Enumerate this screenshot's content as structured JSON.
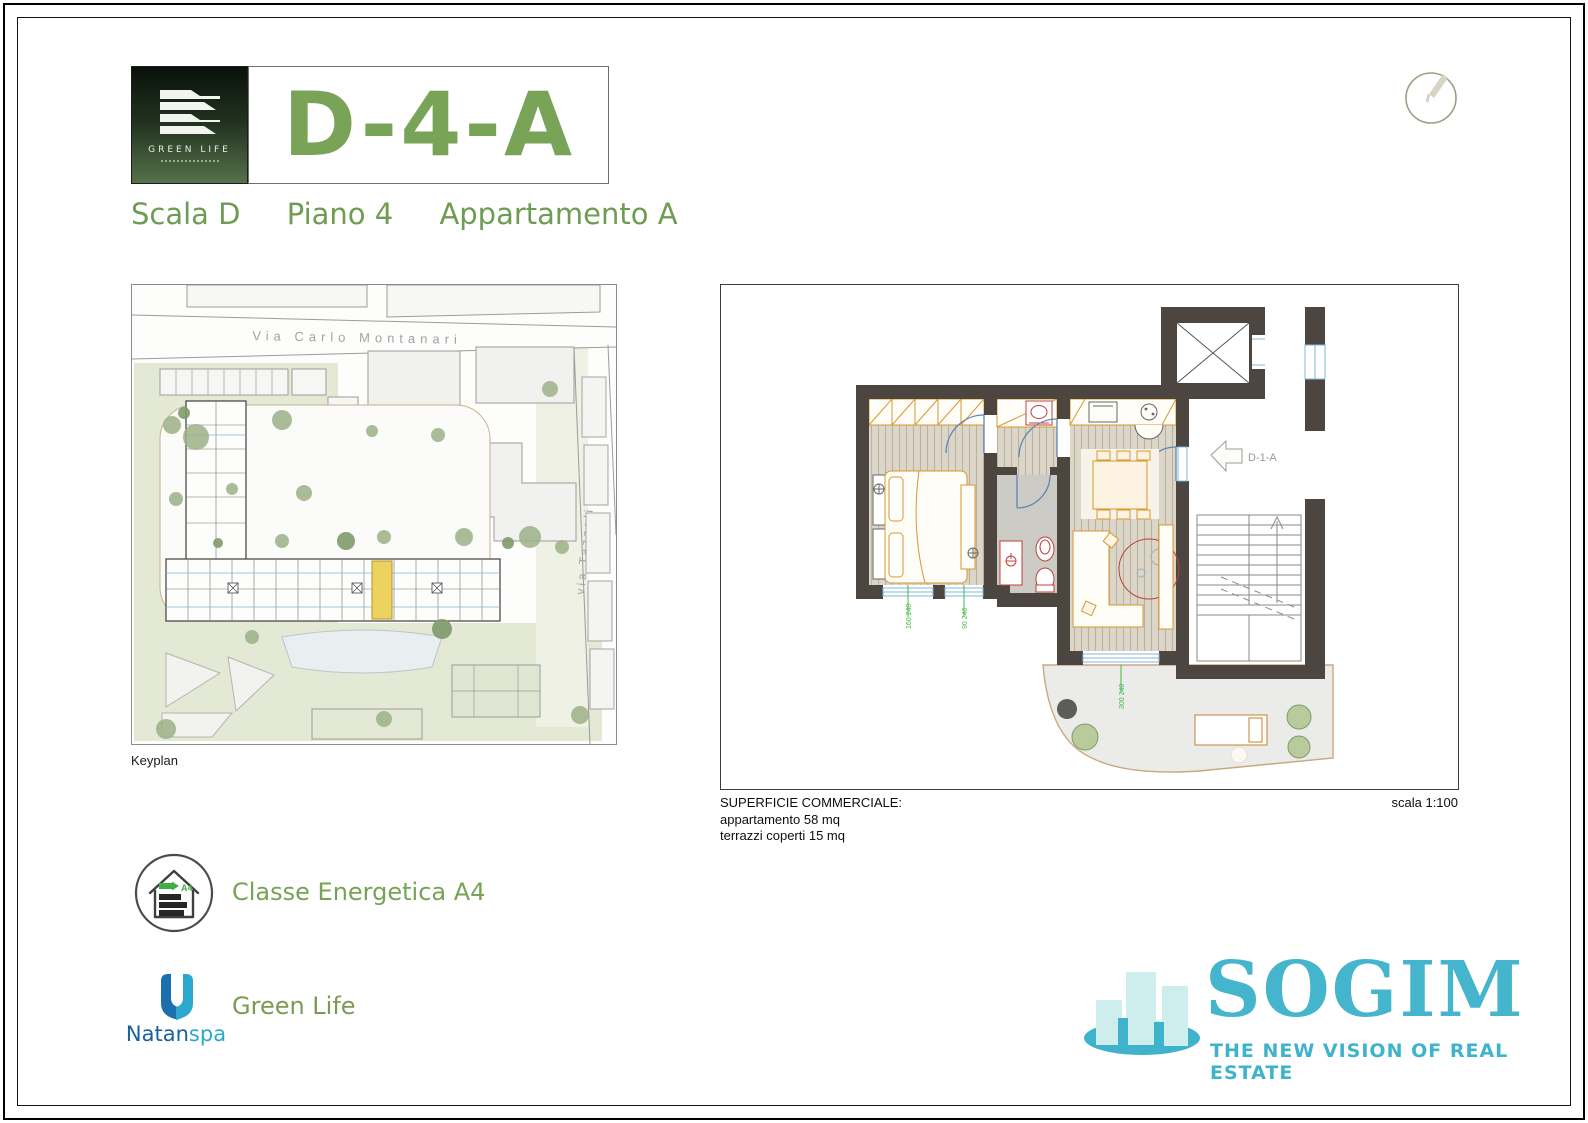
{
  "header": {
    "unit_code": "D-4-A",
    "scala": "Scala D",
    "piano": "Piano 4",
    "appartamento": "Appartamento A",
    "logo_title": "GREEN LIFE"
  },
  "keyplan": {
    "label": "Keyplan",
    "street_top": "Via Carlo Montanari",
    "street_right": "via Tazzoli"
  },
  "plan": {
    "entry_label": "D-1-A",
    "scale_label": "scala 1:100",
    "surface_title": "SUPERFICIE  COMMERCIALE:",
    "surface_line1": "appartamento 58 mq",
    "surface_line2": "terrazzi coperti 15 mq",
    "dims": [
      "160 240",
      "90 240",
      "300 240"
    ]
  },
  "energy": {
    "label": "Classe Energetica A4",
    "badge": "A4"
  },
  "developer": {
    "name_part1": "Natan",
    "name_part2": "spa",
    "project": "Green Life"
  },
  "brand": {
    "name": "SOGIM",
    "tagline": "THE NEW VISION OF REAL ESTATE"
  },
  "colors": {
    "accent_green": "#76a355",
    "logo_dark_green": "#0a110b",
    "wall": "#4d4640",
    "furniture_orange": "#d9972f",
    "fixture_red": "#c04038",
    "window_blue": "#7fb8d8",
    "dim_green": "#46b846",
    "highlight_yellow": "#ecd25e",
    "site_green": "#e3e9d4",
    "brand_teal": "#3fb3cb",
    "natan_blue": "#16629f",
    "natan_teal": "#2aa9cc"
  }
}
